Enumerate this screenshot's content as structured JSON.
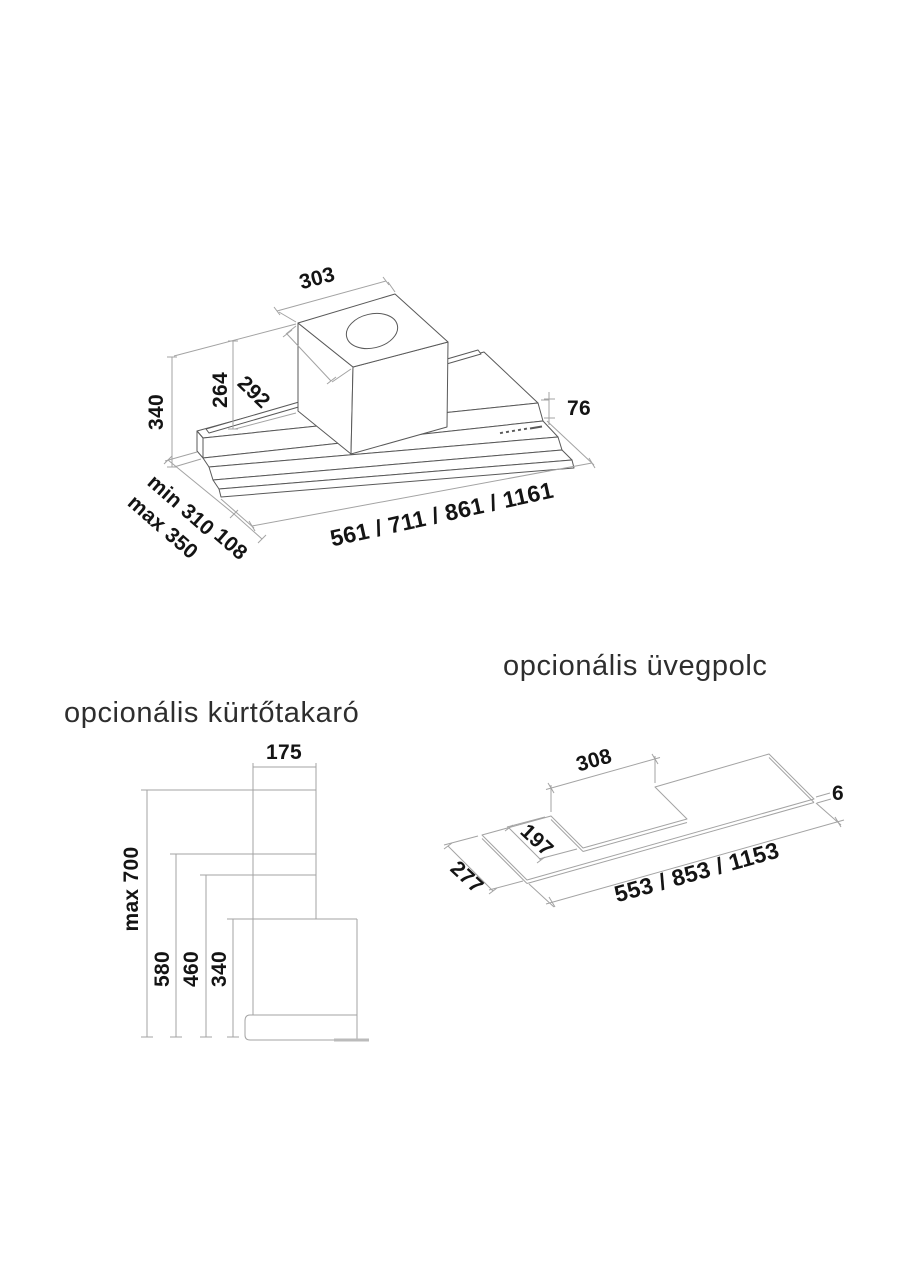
{
  "titles": {
    "chimney_cover": "opcionális kürtőtakaró",
    "glass_shelf": "opcionális üvegpolc"
  },
  "hood_diagram": {
    "top_box_width": "303",
    "top_box_depth": "292",
    "top_box_height": "264",
    "total_height": "340",
    "front_panel_height": "76",
    "depth_min": "min 310",
    "depth_max": "max 350",
    "slide_out_depth": "108",
    "width_options": "561 / 711 / 861 / 1161"
  },
  "chimney_diagram": {
    "chimney_width": "175",
    "max_height": "max 700",
    "height_1": "580",
    "height_2": "460",
    "height_3": "340"
  },
  "shelf_diagram": {
    "notch_width": "308",
    "glass_thickness": "6",
    "notch_depth": "197",
    "shelf_depth": "277",
    "width_options": "553 / 853 / 1153"
  },
  "colors": {
    "background": "#ffffff",
    "object_line": "#595959",
    "light_line": "#a3a3a3",
    "dimension_text": "#141414",
    "title_text": "#2e2e2e"
  }
}
